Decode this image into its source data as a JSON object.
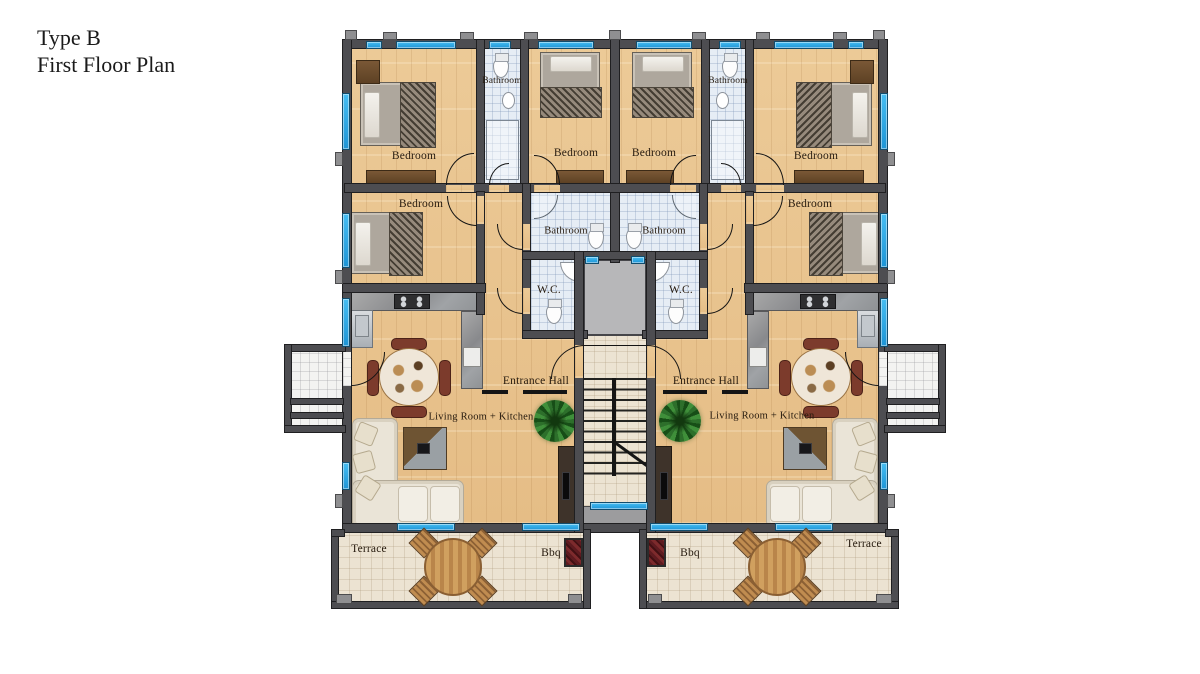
{
  "title": {
    "type": "Type B",
    "floor": "First Floor Plan"
  },
  "labels": {
    "bedroom": "Bedroom",
    "bathroom": "Bathroom",
    "wc": "W.C.",
    "entrance_hall": "Entrance Hall",
    "living_kitchen": "Living Room + Kitchen",
    "terrace": "Terrace",
    "bbq": "Bbq"
  },
  "rooms": [
    {
      "id": "bedroom-top-left",
      "label": "Bedroom"
    },
    {
      "id": "bathroom-top-left",
      "label": "Bathroom"
    },
    {
      "id": "bedroom-top-center-left",
      "label": "Bedroom"
    },
    {
      "id": "bedroom-top-center-right",
      "label": "Bedroom"
    },
    {
      "id": "bathroom-top-right",
      "label": "Bathroom"
    },
    {
      "id": "bedroom-top-right",
      "label": "Bedroom"
    },
    {
      "id": "bedroom-mid-left",
      "label": "Bedroom"
    },
    {
      "id": "bedroom-mid-right",
      "label": "Bedroom"
    },
    {
      "id": "bathroom-core-left",
      "label": "Bathroom"
    },
    {
      "id": "bathroom-core-right",
      "label": "Bathroom"
    },
    {
      "id": "wc-left",
      "label": "W.C."
    },
    {
      "id": "wc-right",
      "label": "W.C."
    },
    {
      "id": "entrance-hall-left",
      "label": "Entrance Hall"
    },
    {
      "id": "entrance-hall-right",
      "label": "Entrance Hall"
    },
    {
      "id": "living-kitchen-left",
      "label": "Living Room + Kitchen"
    },
    {
      "id": "living-kitchen-right",
      "label": "Living Room + Kitchen"
    },
    {
      "id": "terrace-left",
      "label": "Terrace"
    },
    {
      "id": "bbq-left",
      "label": "Bbq"
    },
    {
      "id": "bbq-right",
      "label": "Bbq"
    },
    {
      "id": "terrace-right",
      "label": "Terrace"
    }
  ],
  "colors": {
    "background": "#ffffff",
    "wall_gray": "#4d4d51",
    "window_blue": "#2aa7e8",
    "wood_floor": "#e9c792",
    "bathroom_tile": "#e6edf5",
    "terrace_stone": "#ece3d2",
    "stair_core_gray": "#b7b7b9",
    "bbq_red": "#6b1a20",
    "plant_green": "#2d6f2b",
    "label_text": "#261a0e"
  }
}
